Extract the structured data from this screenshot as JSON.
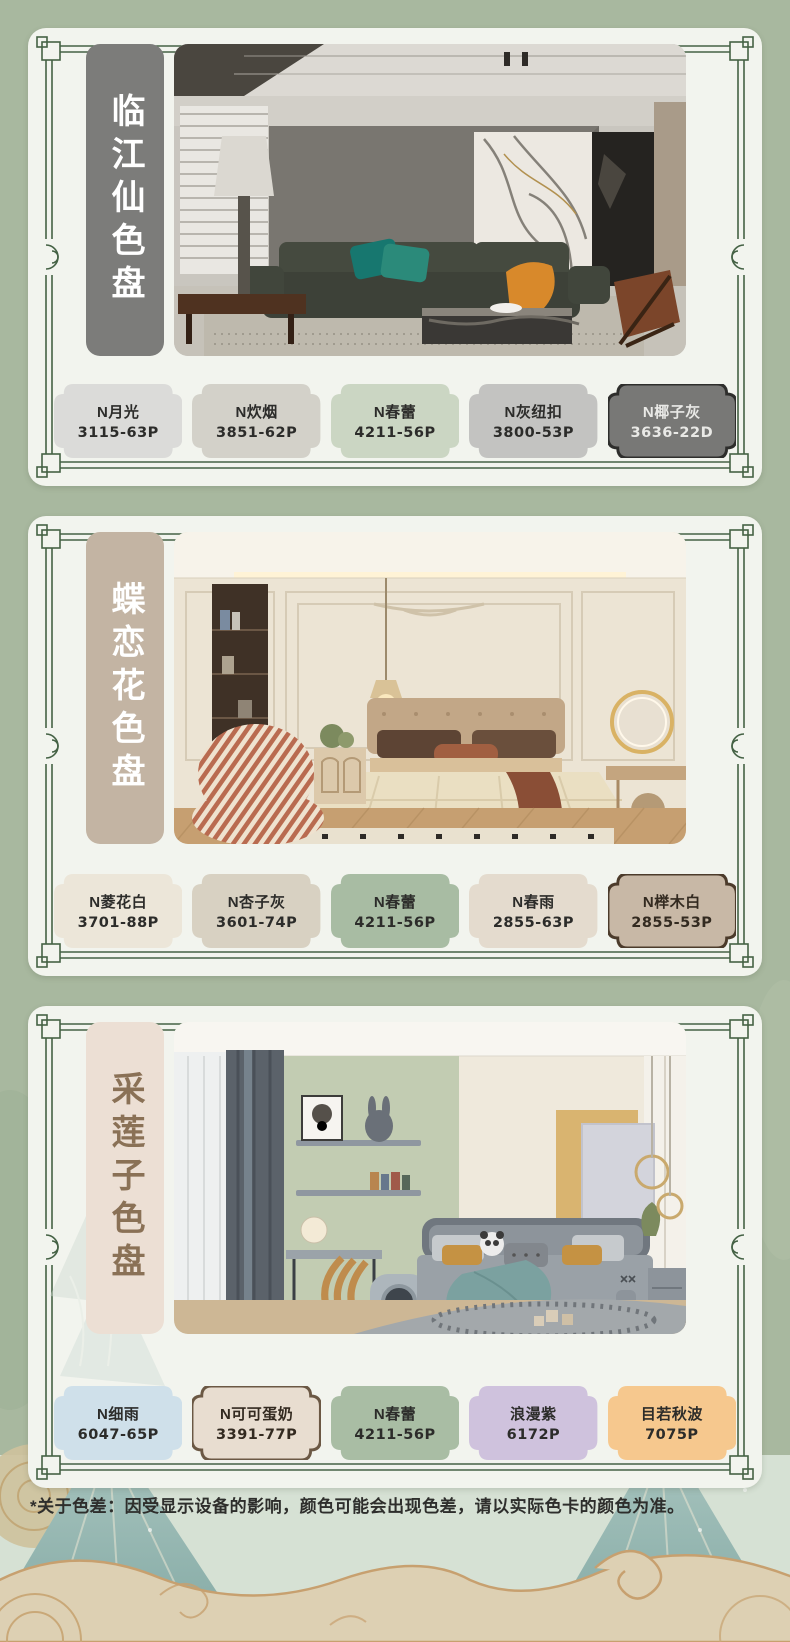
{
  "page": {
    "bg_color": "#a8b89f",
    "panel_bg": "#f2f4ee",
    "frame_color": "#456245"
  },
  "disclaimer": "*关于色差：因受显示设备的影响，颜色可能会出现色差，请以实际色卡的颜色为准。",
  "panels": [
    {
      "title": "临江仙色盘",
      "title_bg": "#7c7c7a",
      "title_color": "#ffffff",
      "photo": "living-room",
      "swatches": [
        {
          "name": "N月光",
          "code": "3115-63P",
          "fill": "#dbdbd9",
          "text": "#2c2c2a"
        },
        {
          "name": "N炊烟",
          "code": "3851-62P",
          "fill": "#d3d1c9",
          "text": "#2c2c2a"
        },
        {
          "name": "N春蕾",
          "code": "4211-56P",
          "fill": "#cbd6c3",
          "text": "#2c2c2a"
        },
        {
          "name": "N灰纽扣",
          "code": "3800-53P",
          "fill": "#c3c3c1",
          "text": "#2c2c2a"
        },
        {
          "name": "N椰子灰",
          "code": "3636-22D",
          "fill": "#787876",
          "text": "#e9e9e6",
          "border": "#2e2e2c"
        }
      ]
    },
    {
      "title": "蝶恋花色盘",
      "title_bg": "#c3b4a3",
      "title_color": "#ffffff",
      "photo": "bedroom",
      "swatches": [
        {
          "name": "N菱花白",
          "code": "3701-88P",
          "fill": "#ece6d9",
          "text": "#2c2c2a"
        },
        {
          "name": "N杏子灰",
          "code": "3601-74P",
          "fill": "#d8d1c2",
          "text": "#2c2c2a"
        },
        {
          "name": "N春蕾",
          "code": "4211-56P",
          "fill": "#a8bca3",
          "text": "#2c2c2a"
        },
        {
          "name": "N春雨",
          "code": "2855-63P",
          "fill": "#e4dbce",
          "text": "#2c2c2a"
        },
        {
          "name": "N榉木白",
          "code": "2855-53P",
          "fill": "#c8b8a6",
          "text": "#332a20",
          "border": "#4c3b2b"
        }
      ]
    },
    {
      "title": "采莲子色盘",
      "title_bg": "#ecdfd4",
      "title_color": "#8a7156",
      "photo": "kids-room",
      "swatches": [
        {
          "name": "N细雨",
          "code": "6047-65P",
          "fill": "#cfe0ea",
          "text": "#2c2c2a"
        },
        {
          "name": "N可可蛋奶",
          "code": "3391-77P",
          "fill": "#e8ddd0",
          "text": "#332a20",
          "border": "#6b5844"
        },
        {
          "name": "N春蕾",
          "code": "4211-56P",
          "fill": "#a9bda4",
          "text": "#2c2c2a"
        },
        {
          "name": "浪漫紫",
          "code": "6172P",
          "fill": "#cfc2dd",
          "text": "#2c2c2a"
        },
        {
          "name": "目若秋波",
          "code": "7075P",
          "fill": "#f6c88e",
          "text": "#2c2c2a"
        }
      ]
    }
  ]
}
